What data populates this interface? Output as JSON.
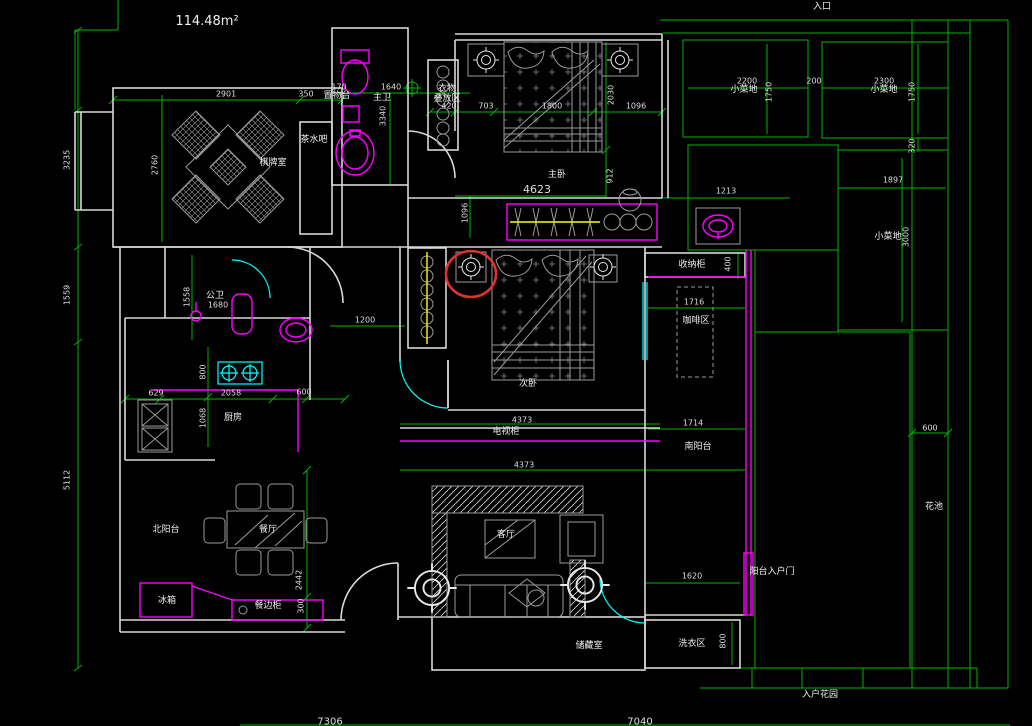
{
  "drawing": {
    "type": "cad-floor-plan",
    "area_label": "114.48m²"
  },
  "colors": {
    "background": "#000000",
    "wall": "#d8d8d8",
    "furniture": "#9a9a9a",
    "dimension_line": "#00b400",
    "dimension_text": "#dedede",
    "label_text": "#f0f0f0",
    "fixture": "#ff00ff",
    "door": "#00ffff",
    "rod": "#ffff00",
    "highlight": "#e03030"
  },
  "room_labels": [
    {
      "t": "114.48m²",
      "x": 207,
      "y": 22,
      "s": 13
    },
    {
      "t": "入口",
      "x": 822,
      "y": 8
    },
    {
      "t": "棋牌室",
      "x": 273,
      "y": 164
    },
    {
      "t": "茶水吧",
      "x": 314,
      "y": 141
    },
    {
      "t": "置物台",
      "x": 337,
      "y": 97
    },
    {
      "t": "主卫",
      "x": 382,
      "y": 99
    },
    {
      "t": "衣物\n叠放区",
      "x": 447,
      "y": 95
    },
    {
      "t": "主卧",
      "x": 557,
      "y": 176
    },
    {
      "t": "次卧",
      "x": 528,
      "y": 385
    },
    {
      "t": "小菜地",
      "x": 744,
      "y": 91
    },
    {
      "t": "小菜地",
      "x": 884,
      "y": 91
    },
    {
      "t": "小菜地",
      "x": 888,
      "y": 238
    },
    {
      "t": "收纳柜",
      "x": 692,
      "y": 266
    },
    {
      "t": "咖啡区",
      "x": 696,
      "y": 322
    },
    {
      "t": "公卫",
      "x": 215,
      "y": 297
    },
    {
      "t": "厨房",
      "x": 233,
      "y": 419
    },
    {
      "t": "北阳台",
      "x": 166,
      "y": 531
    },
    {
      "t": "餐厅",
      "x": 268,
      "y": 531
    },
    {
      "t": "冰箱",
      "x": 167,
      "y": 602
    },
    {
      "t": "餐边柜",
      "x": 268,
      "y": 607
    },
    {
      "t": "客厅",
      "x": 506,
      "y": 536
    },
    {
      "t": "电视柜",
      "x": 506,
      "y": 433
    },
    {
      "t": "南阳台",
      "x": 698,
      "y": 448
    },
    {
      "t": "储藏室",
      "x": 589,
      "y": 647
    },
    {
      "t": "洗衣区",
      "x": 692,
      "y": 645
    },
    {
      "t": "阳台入户门",
      "x": 772,
      "y": 573
    },
    {
      "t": "花池",
      "x": 934,
      "y": 508
    },
    {
      "t": "入户花园",
      "x": 820,
      "y": 696
    }
  ],
  "dimensions": [
    {
      "v": "2901",
      "x": 226,
      "y": 95
    },
    {
      "v": "350",
      "x": 306,
      "y": 95
    },
    {
      "v": "170",
      "x": 339,
      "y": 88
    },
    {
      "v": "1640",
      "x": 391,
      "y": 88
    },
    {
      "v": "420",
      "x": 449,
      "y": 107
    },
    {
      "v": "703",
      "x": 486,
      "y": 107
    },
    {
      "v": "1800",
      "x": 552,
      "y": 107
    },
    {
      "v": "1096",
      "x": 636,
      "y": 107
    },
    {
      "v": "4623",
      "x": 537,
      "y": 190,
      "s": 11
    },
    {
      "v": "1213",
      "x": 726,
      "y": 192
    },
    {
      "v": "2200",
      "x": 747,
      "y": 82
    },
    {
      "v": "200",
      "x": 814,
      "y": 82
    },
    {
      "v": "2300",
      "x": 884,
      "y": 82
    },
    {
      "v": "1897",
      "x": 893,
      "y": 181
    },
    {
      "v": "1680",
      "x": 218,
      "y": 306
    },
    {
      "v": "1200",
      "x": 365,
      "y": 321
    },
    {
      "v": "629",
      "x": 156,
      "y": 394
    },
    {
      "v": "2058",
      "x": 231,
      "y": 394
    },
    {
      "v": "600",
      "x": 304,
      "y": 393
    },
    {
      "v": "4373",
      "x": 522,
      "y": 421
    },
    {
      "v": "4373",
      "x": 524,
      "y": 466
    },
    {
      "v": "1714",
      "x": 693,
      "y": 424
    },
    {
      "v": "1716",
      "x": 694,
      "y": 303
    },
    {
      "v": "1620",
      "x": 692,
      "y": 577
    },
    {
      "v": "600",
      "x": 930,
      "y": 429
    },
    {
      "v": "7306",
      "x": 330,
      "y": 722,
      "s": 10
    },
    {
      "v": "7040",
      "x": 640,
      "y": 722,
      "s": 10
    },
    {
      "v": "3235",
      "x": 68,
      "y": 160,
      "vert": true
    },
    {
      "v": "1559",
      "x": 68,
      "y": 295,
      "vert": true
    },
    {
      "v": "5112",
      "x": 68,
      "y": 480,
      "vert": true
    },
    {
      "v": "2760",
      "x": 156,
      "y": 165,
      "vert": true
    },
    {
      "v": "3340",
      "x": 384,
      "y": 116,
      "vert": true
    },
    {
      "v": "2030",
      "x": 612,
      "y": 95,
      "vert": true
    },
    {
      "v": "912",
      "x": 611,
      "y": 176,
      "vert": true
    },
    {
      "v": "1750",
      "x": 770,
      "y": 92,
      "vert": true
    },
    {
      "v": "1750",
      "x": 913,
      "y": 92,
      "vert": true
    },
    {
      "v": "320",
      "x": 913,
      "y": 146,
      "vert": true
    },
    {
      "v": "3000",
      "x": 907,
      "y": 237,
      "vert": true
    },
    {
      "v": "1558",
      "x": 188,
      "y": 297,
      "vert": true
    },
    {
      "v": "800",
      "x": 204,
      "y": 372,
      "vert": true
    },
    {
      "v": "1068",
      "x": 204,
      "y": 418,
      "vert": true
    },
    {
      "v": "2442",
      "x": 300,
      "y": 580,
      "vert": true
    },
    {
      "v": "300",
      "x": 302,
      "y": 606,
      "vert": true
    },
    {
      "v": "400",
      "x": 729,
      "y": 264,
      "vert": true
    },
    {
      "v": "800",
      "x": 724,
      "y": 641,
      "vert": true
    },
    {
      "v": "1096",
      "x": 466,
      "y": 213,
      "vert": true
    }
  ],
  "annotation": {
    "note": "red highlight circle over ceiling-light symbol",
    "x": 471,
    "y": 274
  }
}
